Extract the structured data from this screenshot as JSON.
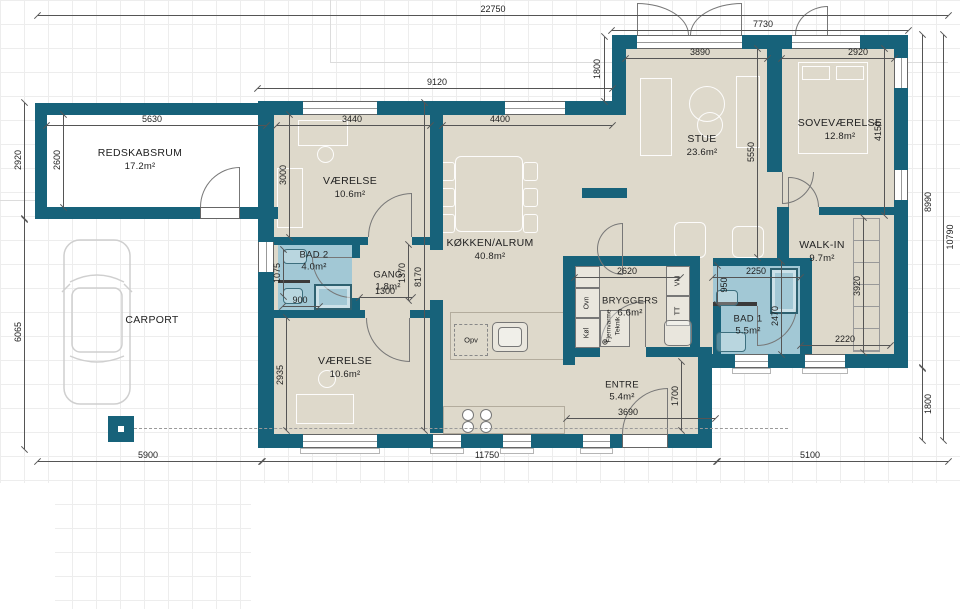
{
  "colors": {
    "wall": "#17627A",
    "floor": "#DED9CB",
    "bath": "#A2C8D5",
    "grid": "#EDEDED",
    "dimline": "#555555"
  },
  "rooms": {
    "redskabsrum": {
      "name": "REDSKABSRUM",
      "area": "17.2m²"
    },
    "carport": {
      "name": "CARPORT",
      "area": ""
    },
    "vaerelse_nw": {
      "name": "VÆRELSE",
      "area": "10.6m²"
    },
    "bad2": {
      "name": "BAD 2",
      "area": "4.0m²"
    },
    "gang": {
      "name": "GANG",
      "area": "1.8m²"
    },
    "vaerelse_sw": {
      "name": "VÆRELSE",
      "area": "10.6m²"
    },
    "koekken": {
      "name": "KØKKEN/ALRUM",
      "area": "40.8m²"
    },
    "stue": {
      "name": "STUE",
      "area": "23.6m²"
    },
    "sovevaerelse": {
      "name": "SOVEVÆRELSE",
      "area": "12.8m²"
    },
    "walkin": {
      "name": "WALK-IN",
      "area": "9.7m²"
    },
    "bryggers": {
      "name": "BRYGGERS",
      "area": "6.6m²"
    },
    "bad1": {
      "name": "BAD 1",
      "area": "5.5m²"
    },
    "entre": {
      "name": "ENTRE",
      "area": "5.4m²"
    }
  },
  "appliances": {
    "opv": "Opv",
    "ovn": "Ovn",
    "koel": "Køl",
    "vm": "VM",
    "tt": "TT",
    "fjernvarme": "Fjernvarme",
    "teknik": "Teknik",
    "symbol": "⊕"
  },
  "dims": [
    "22750",
    "7730",
    "9120",
    "3890",
    "2920",
    "1800",
    "5630",
    "3440",
    "4400",
    "2920",
    "2600",
    "3000",
    "4150",
    "5550",
    "8990",
    "10790",
    "6065",
    "1075",
    "900",
    "1370",
    "1300",
    "8170",
    "2620",
    "2250",
    "950",
    "2470",
    "3920",
    "2220",
    "2935",
    "1700",
    "3690",
    "1800",
    "5900",
    "11750",
    "5100"
  ]
}
